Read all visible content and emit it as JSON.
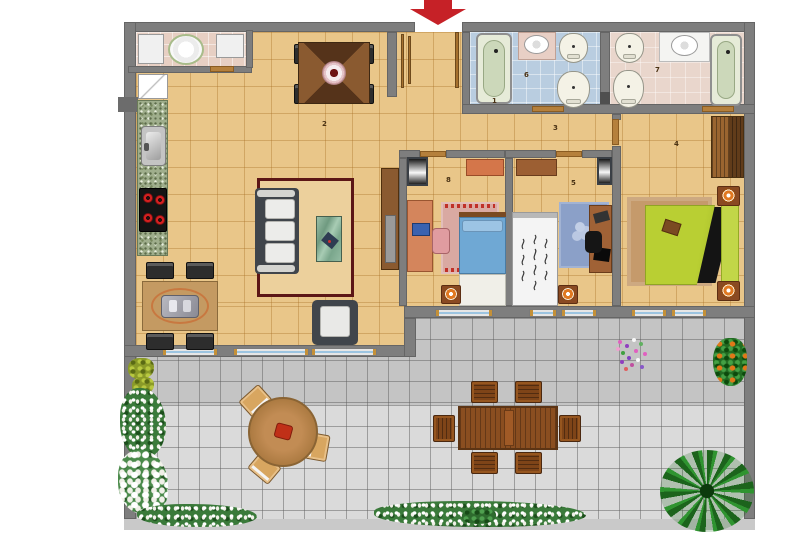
{
  "page": {
    "type": "apartment-floor-plan",
    "view": "top-down",
    "background": "#ffffff"
  },
  "entrance": {
    "marker": "red-arrow-down",
    "arrow_color": "#c62127"
  },
  "room_labels": {
    "entrance_hall": "1",
    "living_room": "2",
    "corridor": "3",
    "bedroom_right": "4",
    "bedroom_middle": "5",
    "bathroom_blue": "6",
    "bathroom_pink": "7",
    "bedroom_left": "8"
  },
  "rooms": [
    {
      "number": "1",
      "name": "entrance hall"
    },
    {
      "number": "2",
      "name": "living / dining room with kitchen"
    },
    {
      "number": "3",
      "name": "corridor"
    },
    {
      "number": "4",
      "name": "bedroom with green bed"
    },
    {
      "number": "5",
      "name": "bedroom with white bed"
    },
    {
      "number": "6",
      "name": "bathroom with blue tiles"
    },
    {
      "number": "7",
      "name": "bathroom with pink tiles"
    },
    {
      "number": "8",
      "name": "bedroom with blue bed"
    }
  ],
  "palette": {
    "wall": "#7e7e7e",
    "interior_floor": "#e9c689",
    "terrace_tile_light": "#dadada",
    "terrace_tile_shaded": "#c4c4c4",
    "bathroom_blue_floor": "#b9cde0",
    "bathroom_pink_floor": "#e9d6cc",
    "utility_floor": "#e7cfc3",
    "bed_blue": "#6fa8d4",
    "bed_white": "#f4f4f4",
    "bed_green": "#b9cf33",
    "arrow_red": "#c62127",
    "plant_green": "#226b22",
    "wood_dark": "#8a4e20"
  }
}
